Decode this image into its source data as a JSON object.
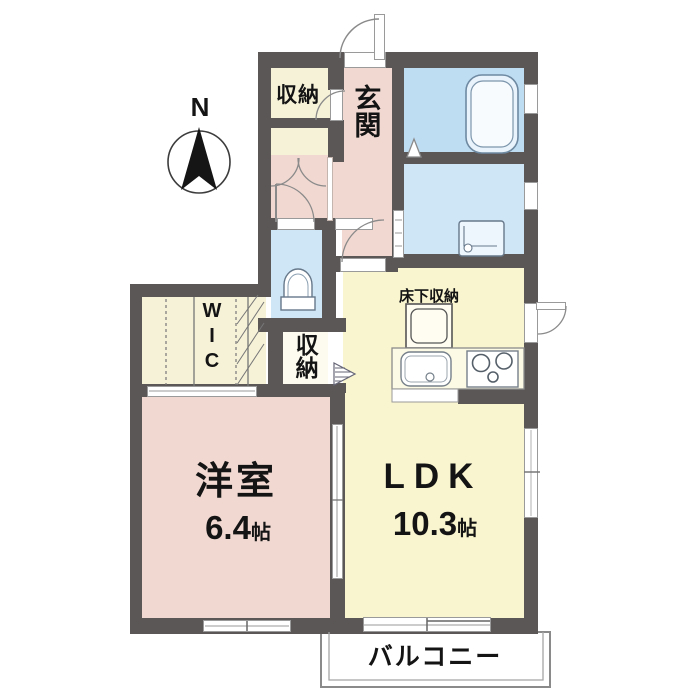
{
  "compass": {
    "north": "N"
  },
  "rooms": {
    "storage_top": {
      "label": "収納"
    },
    "entrance": {
      "label": "玄関"
    },
    "hall_storage": {
      "label": "収納"
    },
    "wic": {
      "label": "WIC"
    },
    "underfloor_storage": {
      "label": "床下収納"
    },
    "western_room": {
      "name": "洋室",
      "size_value": "6.4",
      "size_unit": "帖"
    },
    "ldk": {
      "name": "LDK",
      "size_value": "10.3",
      "size_unit": "帖"
    },
    "balcony": {
      "label": "バルコニー"
    }
  },
  "colors": {
    "wall": "#5b5757",
    "room_pink": "#f1d8d1",
    "room_yellow": "#f9f5cf",
    "room_cream": "#f6f2d8",
    "bath_blue": "#bedcf2",
    "water_blue": "#cfe6f7",
    "closet_white": "#fdfbef"
  }
}
